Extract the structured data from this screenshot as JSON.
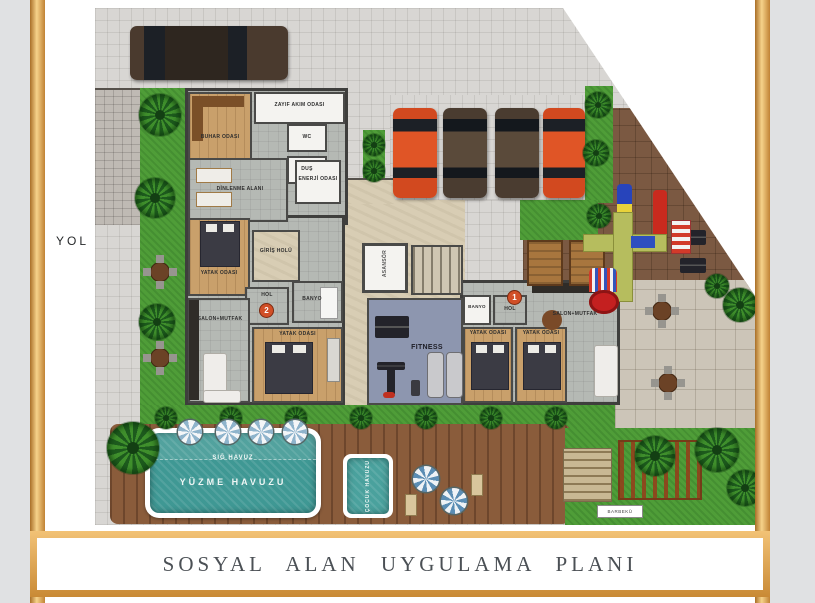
{
  "title": "SOSYAL ALAN UYGULAMA PLANI",
  "road_label": "YOL",
  "spa": {
    "buhar_odasi": "BUHAR ODASI",
    "zayif_akim": "ZAYIF AKIM ODASI",
    "wc": "WC",
    "dus": "DUŞ",
    "dinlenme": "DİNLENME ALANI",
    "enerji": "ENERJİ ODASI"
  },
  "unit2": {
    "number": "2",
    "yatak_odasi_1": "YATAK ODASI",
    "giris_holu": "GİRİŞ HOLÜ",
    "hol": "HOL",
    "banyo": "BANYO",
    "salon_mutfak": "SALON+MUTFAK",
    "yatak_odasi_2": "YATAK ODASI"
  },
  "unit1": {
    "number": "1",
    "hol": "HOL",
    "banyo": "BANYO",
    "salon_mutfak": "SALON+MUTFAK",
    "yatak_odasi_1": "YATAK ODASI",
    "yatak_odasi_2": "YATAK ODASI"
  },
  "core": {
    "fitness": "FITNESS",
    "asansor": "ASANSÖR"
  },
  "pool": {
    "sig_havuz": "SIĞ HAVUZ",
    "yuzme_havuzu": "YÜZME HAVUZU",
    "cocuk_havuzu": "ÇOCUK HAVUZU"
  },
  "amenities": {
    "barbeku": "BARBEKÜ"
  },
  "colors": {
    "frame_gold": "#d99a4e",
    "water_teal": "#3f9894",
    "grass_green": "#4f9d38",
    "pool_deck_brown": "#8a5c3b",
    "play_deck_brown": "#7b5942",
    "unit_marker_red": "#d14f27"
  }
}
